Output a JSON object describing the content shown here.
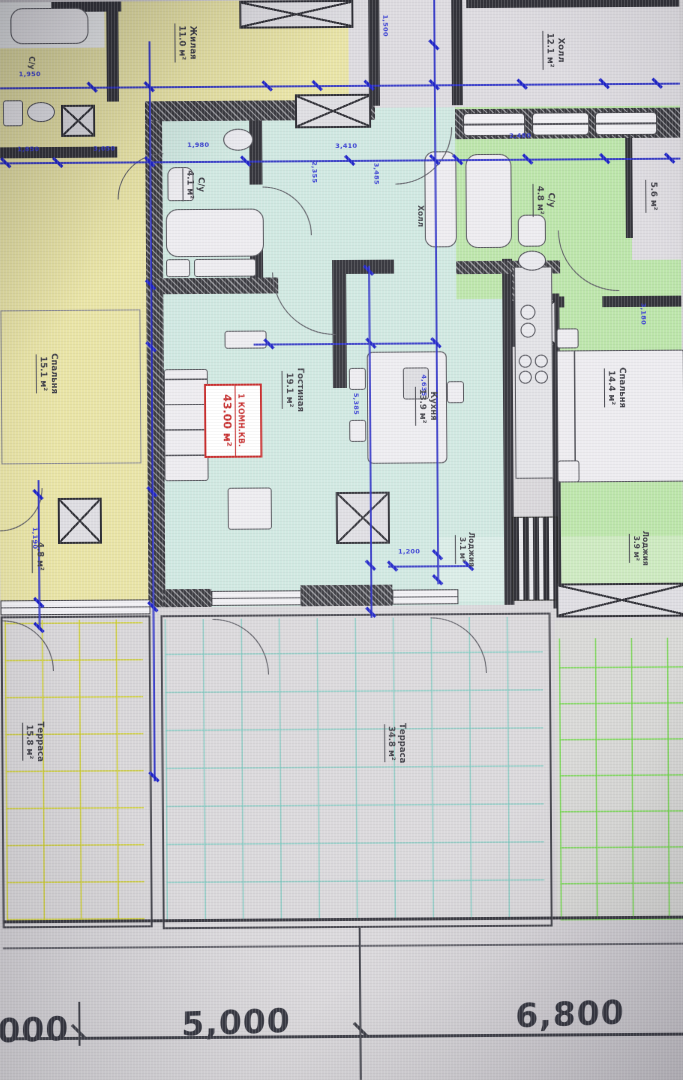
{
  "plan_title": "Apartment floor plan (CAD screenshot)",
  "badge": {
    "line1": "1 КОМН.КВ.",
    "line2": "43.00 м²"
  },
  "rooms": [
    {
      "name": "Жилая",
      "area": "11.0 м²"
    },
    {
      "name": "Холл",
      "area": "12.1 м²"
    },
    {
      "name": "С/у",
      "area": ""
    },
    {
      "name": "С/у",
      "area": "4.1 м²"
    },
    {
      "name": "Холл",
      "area": ""
    },
    {
      "name": "С/у",
      "area": "4.8 м²"
    },
    {
      "name": "",
      "area": "5.6 м²"
    },
    {
      "name": "Спальня",
      "area": "15.1 м²"
    },
    {
      "name": "Гостиная",
      "area": "19.1 м²"
    },
    {
      "name": "Кухня",
      "area": "13.9 м²"
    },
    {
      "name": "Спальня",
      "area": "14.4 м²"
    },
    {
      "name": "",
      "area": "4.8 м²"
    },
    {
      "name": "Лоджия",
      "area": "3.1 м²"
    },
    {
      "name": "Лоджия",
      "area": "3.9 м²"
    },
    {
      "name": "Терраса",
      "area": "15.8 м²"
    },
    {
      "name": "Терраса",
      "area": "34.8 м²"
    }
  ],
  "dims_h": [
    "1,950",
    "1,850",
    "3,050",
    "1,980",
    "3,410",
    "2,480",
    "1,200"
  ],
  "dims_v": [
    "1,500",
    "2,355",
    "3,485",
    "5,385",
    "4,635",
    "3,180",
    "1,190"
  ],
  "ruler": [
    "000",
    "5,000",
    "6,800"
  ],
  "colors": {
    "dimension_blue": "#2a2fc6",
    "wall_dark": "#33333a",
    "apartment_yellow": "#e9e4a6",
    "apartment_cyan": "#cfe8e1",
    "apartment_green": "#bce5aa",
    "badge_red": "#c62828",
    "paper_gray": "#d7d5d9"
  }
}
